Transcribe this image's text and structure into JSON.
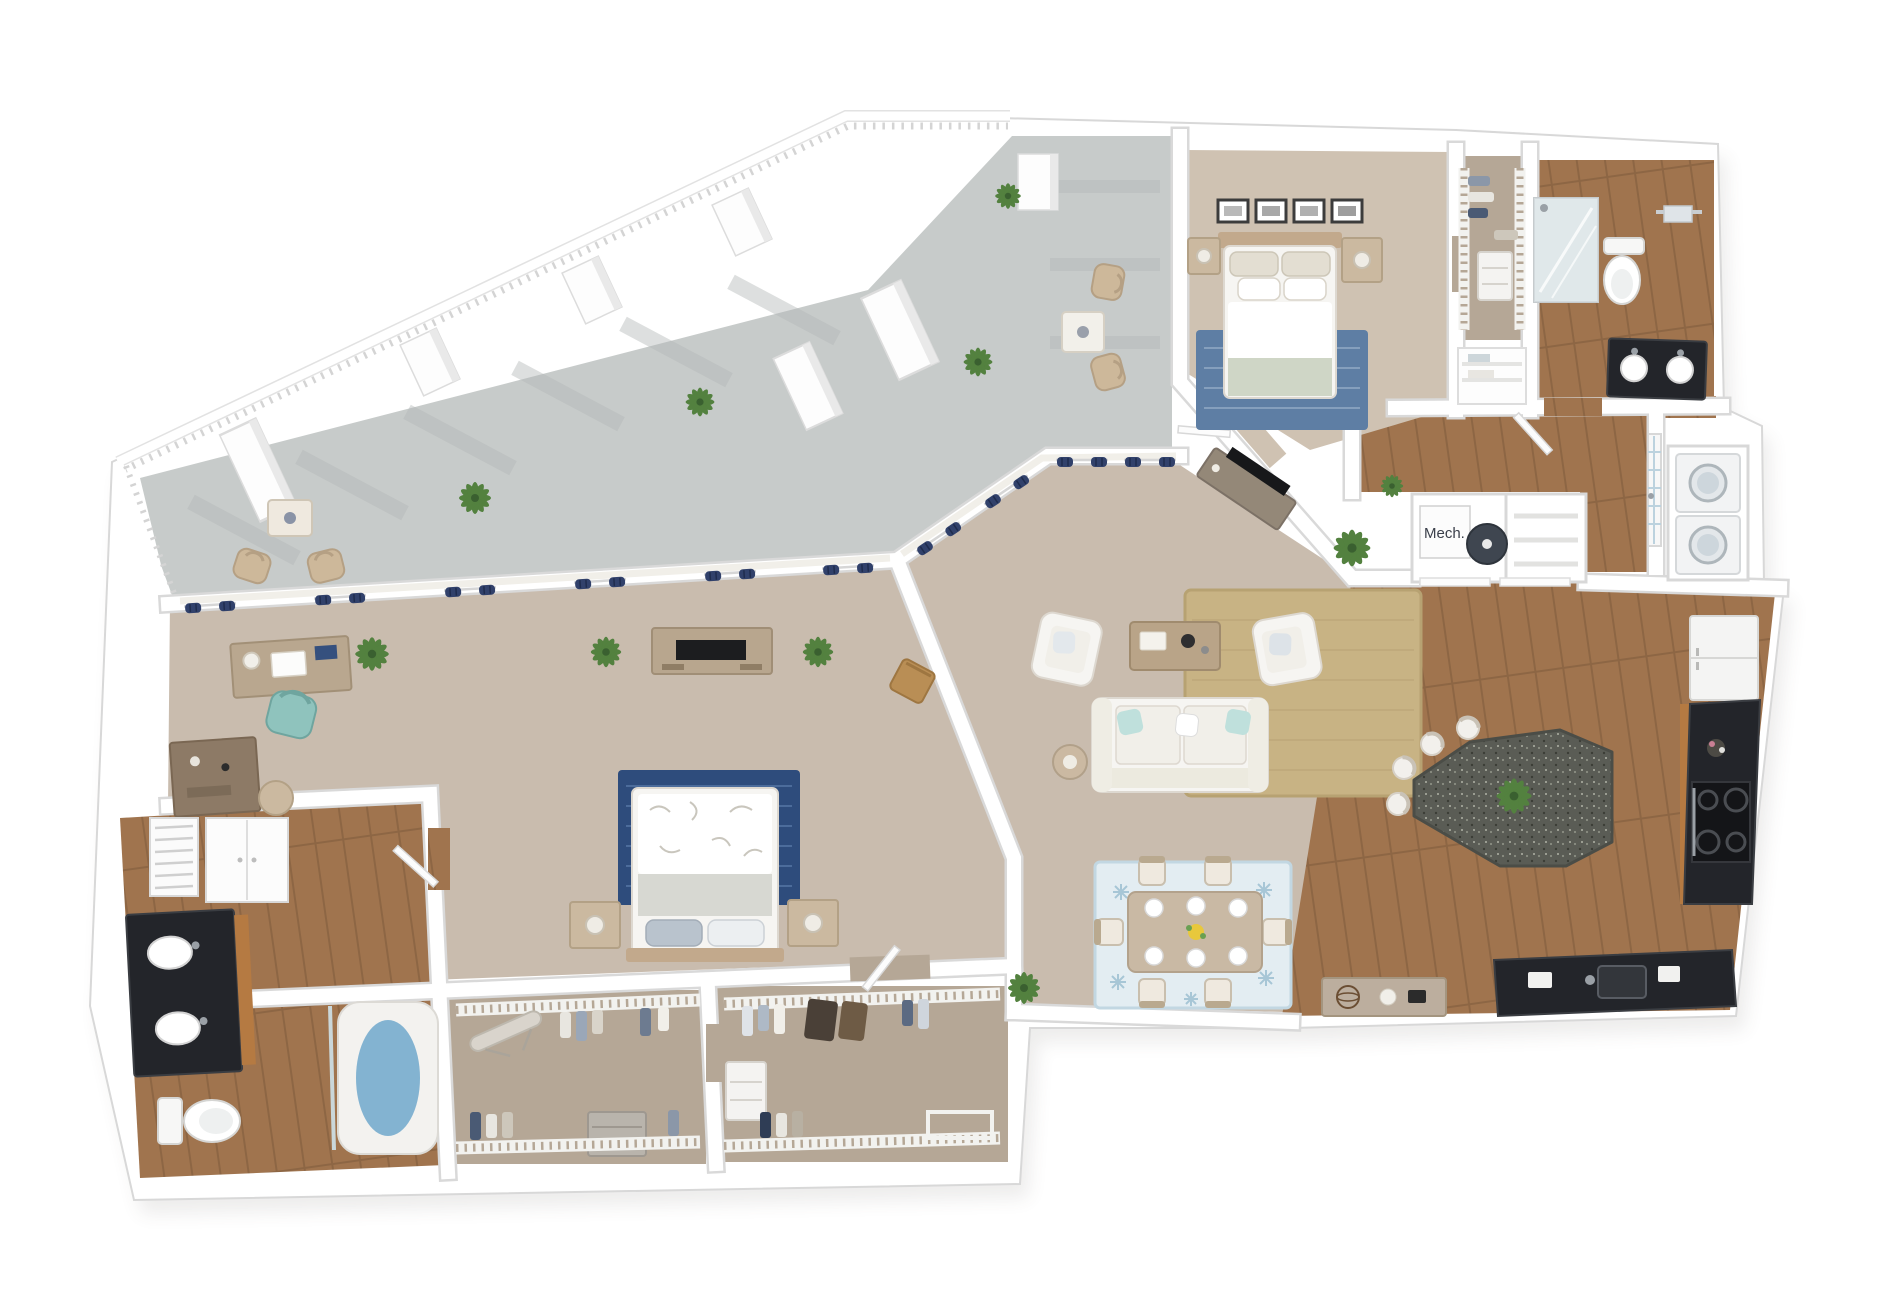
{
  "labels": {
    "mech": "Mech."
  },
  "scene": {
    "kind": "3d-rendered-floor-plan",
    "view": "isometric top-down",
    "unit_summary": "two-bedroom / two-bathroom apartment with wrap-around balcony, open living-dining-kitchen, walk-in closets and mechanical closet"
  },
  "palette": {
    "background": "#ffffff",
    "wall": "#ffffff",
    "wall_edge": "#d8d8d8",
    "terrace": "#c7cbca",
    "terrace_stripe": "#b4b8b7",
    "carpet": "#c9bcae",
    "carpet_bed2": "#cfc2b2",
    "closet_carpet": "#b5a796",
    "wood": "#a0744e",
    "wood_dark": "#8d6644",
    "curtain_navy": "#31416b",
    "rug_navy": "#2e4c7c",
    "rug_navy_streak": "#5474a3",
    "rug_bed2": "#5e7ea4",
    "rug_jute": "#c8b384",
    "rug_dining": "#e3edf2",
    "rug_dining_accent": "#a7c6d6",
    "sofa_white": "#f6f5f2",
    "island": "#5a5c55",
    "counter_black": "#23252a",
    "cabinet_wood": "#b57a42",
    "teal_chair": "#8fc3bd",
    "tan_furniture": "#c2a98c",
    "plant_green": "#53813f",
    "tub_water": "#6fa8cb",
    "appliance_gray": "#3f4650",
    "frame_dark": "#3c3c3c"
  },
  "rooms": [
    {
      "name": "balcony-terrace",
      "floor": "concrete",
      "furniture": [
        "lounge chairs",
        "bistro table",
        "wicker patio chairs",
        "patio side table",
        "potted plants",
        "railing",
        "columns"
      ]
    },
    {
      "name": "master-bedroom",
      "floor": "carpet",
      "furniture": [
        "bed with floral duvet",
        "navy area rug",
        "nightstands",
        "table lamps",
        "tv console with tv",
        "writing desk",
        "teal desk chair",
        "dresser",
        "wood accent chair",
        "potted plants",
        "navy curtains"
      ]
    },
    {
      "name": "master-bathroom",
      "floor": "wood",
      "furniture": [
        "double vanity with two sinks",
        "toilet",
        "soaking tub",
        "glass panel",
        "storage cabinet",
        "louvered utility closet"
      ]
    },
    {
      "name": "walk-in-closet-left",
      "floor": "carpet",
      "furniture": [
        "wire shelving",
        "hanging clothes",
        "ironing board",
        "drawer unit"
      ]
    },
    {
      "name": "walk-in-closet-right",
      "floor": "carpet",
      "furniture": [
        "wire shelving",
        "hanging clothes",
        "drawer unit",
        "suitcases",
        "shoe rack"
      ]
    },
    {
      "name": "living-room",
      "floor": "carpet",
      "furniture": [
        "white sofa",
        "two armchairs",
        "coffee table",
        "jute rug",
        "floor lamp",
        "angled tv console with tv",
        "potted plants",
        "navy curtains"
      ]
    },
    {
      "name": "dining-area",
      "floor": "carpet",
      "furniture": [
        "dining table",
        "six chairs",
        "six place settings",
        "yellow centerpiece",
        "blue starfish rug",
        "console table with decor"
      ]
    },
    {
      "name": "kitchen",
      "floor": "wood",
      "furniture": [
        "granite island",
        "bar stools",
        "island plant",
        "refrigerator",
        "range with four burners",
        "wood cabinets",
        "black countertop",
        "sink"
      ]
    },
    {
      "name": "entry",
      "floor": "wood",
      "furniture": [
        "glass-paned front door",
        "stacked washer and dryer closet"
      ]
    },
    {
      "name": "mechanical-closet",
      "floor": "wood",
      "furniture": [
        "water heater",
        "mechanical unit box",
        "storage shelves"
      ]
    },
    {
      "name": "bedroom-2",
      "floor": "carpet",
      "furniture": [
        "bed with sage throw",
        "nightstands",
        "table lamps",
        "four framed pictures",
        "blue rug"
      ]
    },
    {
      "name": "closet-2",
      "floor": "carpet",
      "furniture": [
        "wire shelving",
        "hanging clothes",
        "drawer unit"
      ]
    },
    {
      "name": "bathroom-2",
      "floor": "wood",
      "furniture": [
        "glass shower",
        "toilet",
        "towel bar",
        "dark-top vanity with two sinks"
      ]
    },
    {
      "name": "hallway",
      "floor": "wood",
      "furniture": [
        "linen closet"
      ]
    }
  ]
}
